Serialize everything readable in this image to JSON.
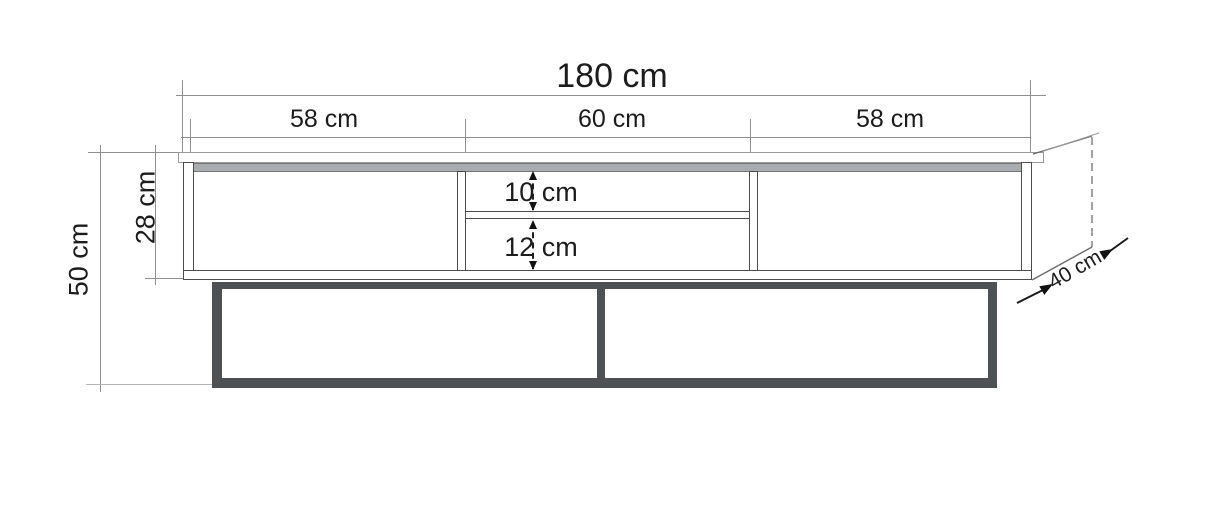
{
  "diagram": {
    "type": "furniture-dimension-drawing",
    "subject": "TV stand front elevation with shelf openings and metal base frame",
    "labels": {
      "total_width": "180 cm",
      "sections": [
        "58 cm",
        "60 cm",
        "58 cm"
      ],
      "total_height": "50 cm",
      "carcass_height": "28 cm",
      "upper_opening": "10 cm",
      "lower_opening": "12 cm",
      "depth": "40 cm"
    },
    "colors": {
      "background": "#ffffff",
      "outline": "#4c4c4c",
      "dimension_line": "#8f8f8f",
      "top_strip": "#a8acb0",
      "base_frame": "#4e5154",
      "text": "#1c1c1c"
    }
  }
}
